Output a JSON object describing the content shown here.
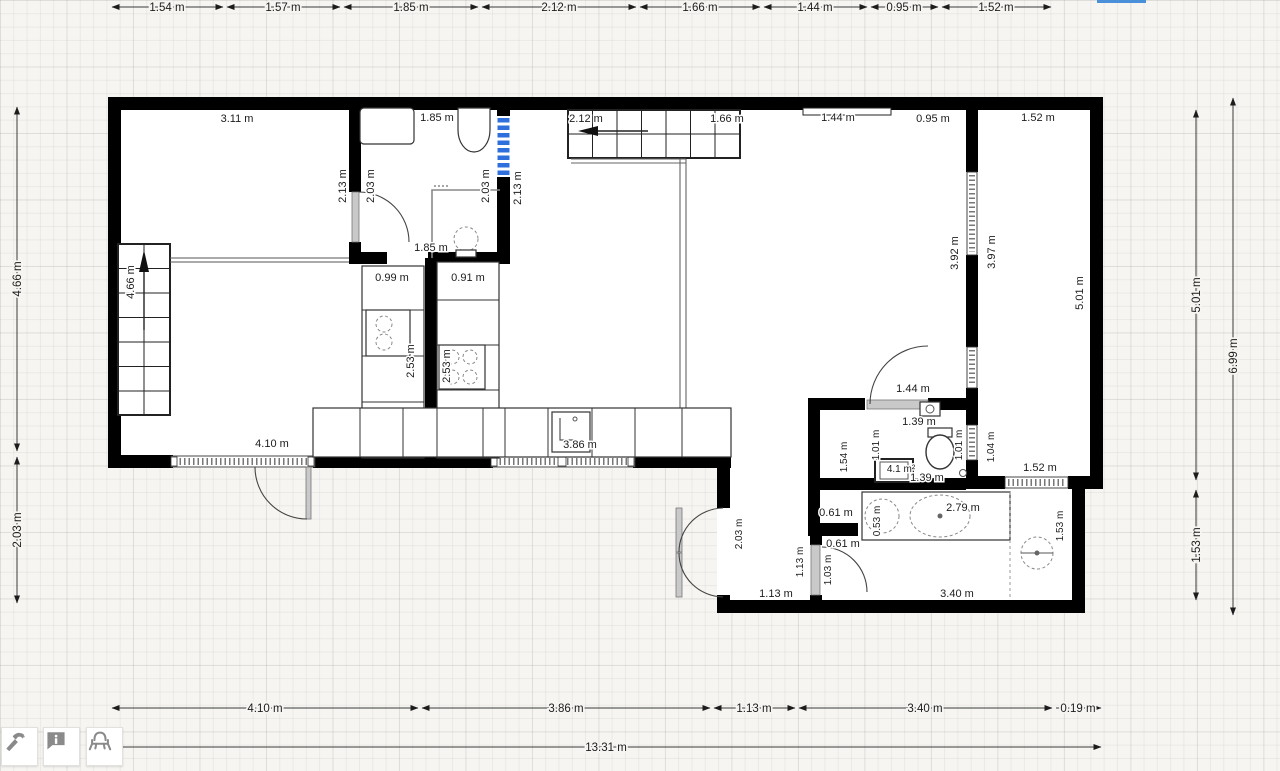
{
  "editor": {
    "selection_color": "#2f6fdd",
    "wall_color": "#000000",
    "grid_color": "#e9e7e3",
    "toolbar": {
      "buttons": [
        {
          "id": "build-tool",
          "icon": "hammer-icon"
        },
        {
          "id": "annotation-tool",
          "icon": "info-bubble-icon"
        },
        {
          "id": "furniture-tool",
          "icon": "armchair-icon"
        }
      ]
    }
  },
  "dimensions": {
    "top": [
      "1.54 m",
      "1.57 m",
      "1.85 m",
      "2.12 m",
      "1.66 m",
      "1.44 m",
      "0.95 m",
      "1.52 m"
    ],
    "left": [
      "4.66 m",
      "2.03 m"
    ],
    "right_inner": [
      "5.01 m",
      "1.53 m"
    ],
    "right_outer": "6.99 m",
    "bottom": [
      "4.10 m",
      "3.86 m",
      "1.13 m",
      "3.40 m",
      "0.19 m"
    ],
    "bottom_total": "13.31 m"
  },
  "interior_labels": {
    "horizontal": [
      "3.11 m",
      "1.85 m",
      "2.12 m",
      "1.66 m",
      "1.44 m",
      "0.95 m",
      "1.52 m",
      "1.85 m",
      "0.99 m",
      "0.91 m",
      "4.10 m",
      "3.86 m",
      "1.44 m",
      "1.39 m",
      "4.1 m²",
      "1.39 m",
      "2.79 m",
      "1.52 m",
      "0.61 m",
      "0.61 m",
      "1.13 m",
      "3.40 m"
    ],
    "vertical": [
      "2.13 m",
      "2.03 m",
      "2.03 m",
      "2.13 m",
      "4.66 m",
      "2.53 m",
      "2.53 m",
      "3.92 m",
      "3.97 m",
      "5.01 m",
      "1.54 m",
      "1.01 m",
      "1.01 m",
      "1.04 m",
      "0.53 m",
      "1.53 m",
      "1.03 m",
      "1.13 m",
      "2.03 m"
    ]
  }
}
